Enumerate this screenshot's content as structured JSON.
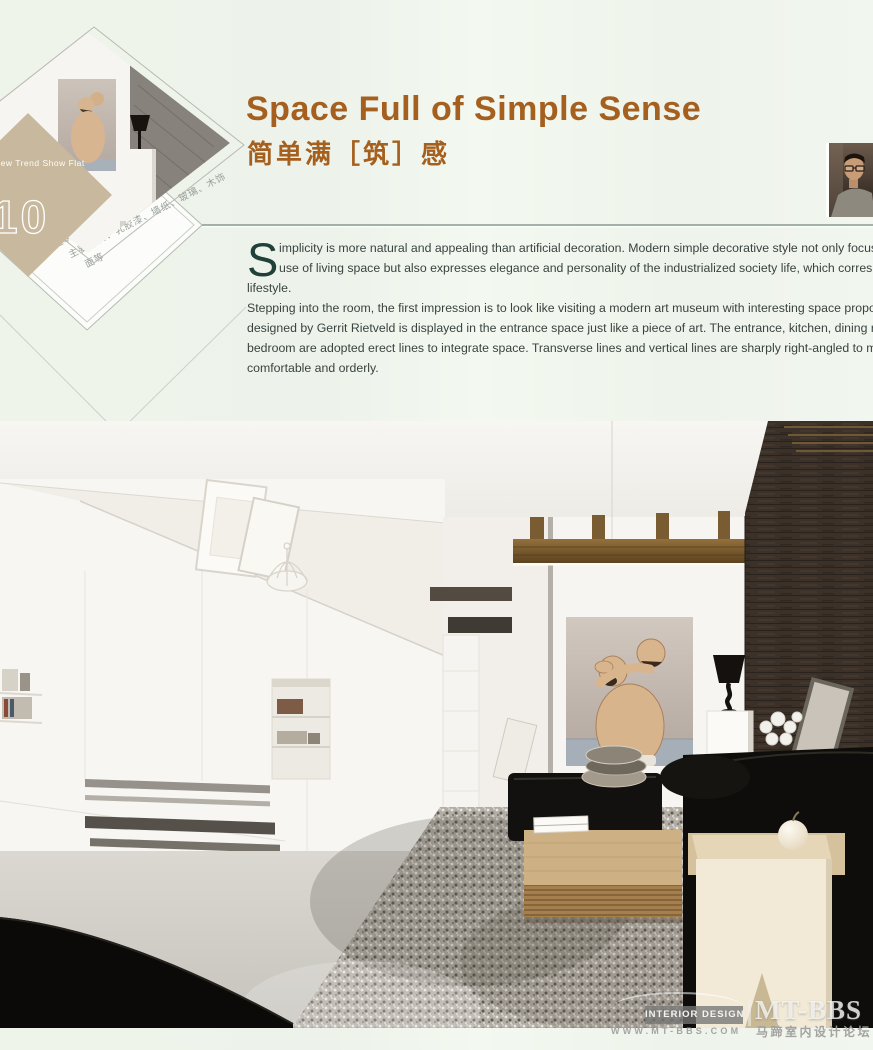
{
  "header": {
    "series_label": "New Trend Show Flat",
    "series_number": "10",
    "title_en": "Space Full of Simple Sense",
    "title_cn": "简单满［筑］感",
    "project_info": [
      "设计公司：C.DD（尺道）设计师事务所",
      "设 计 师：杨铭斌",
      "项目地点：广东佛山",
      "建筑面积：122.5m²",
      "主要材料：乳胶漆、墙纸、玻璃、木饰",
      "面等"
    ]
  },
  "article": {
    "dropcap": "S",
    "lines": [
      "implicity is more natural and appealing than artificial decoration. Modern simple decorative style not only focuses on the practical",
      "use of living space but also expresses elegance and personality of the industrialized society life, which corresponds with modern",
      "lifestyle.",
      "Stepping into the room, the first impression is to look like visiting a modern art museum with interesting space proportion. A Zig-Zag C",
      "designed by Gerrit Rietveld is displayed in the entrance space just like a piece of art. The entrance, kitchen, dining room, living room",
      "bedroom are adopted erect lines to integrate space. Transverse lines and vertical lines are sharply right-angled to make overall la",
      "comfortable and orderly."
    ]
  },
  "watermark": {
    "badge": "INTERIOR DESIGN",
    "brand": "MT-BBS",
    "url": "WWW.MT-BBS.COM",
    "site_cn": "马蹄室内设计论坛"
  },
  "colors": {
    "accent_title": "#a5601f",
    "body_text": "#39423f",
    "tan_diamond": "#c8b99e",
    "dark_wall": "#3b3129",
    "page_bg": "#eff5ec"
  }
}
